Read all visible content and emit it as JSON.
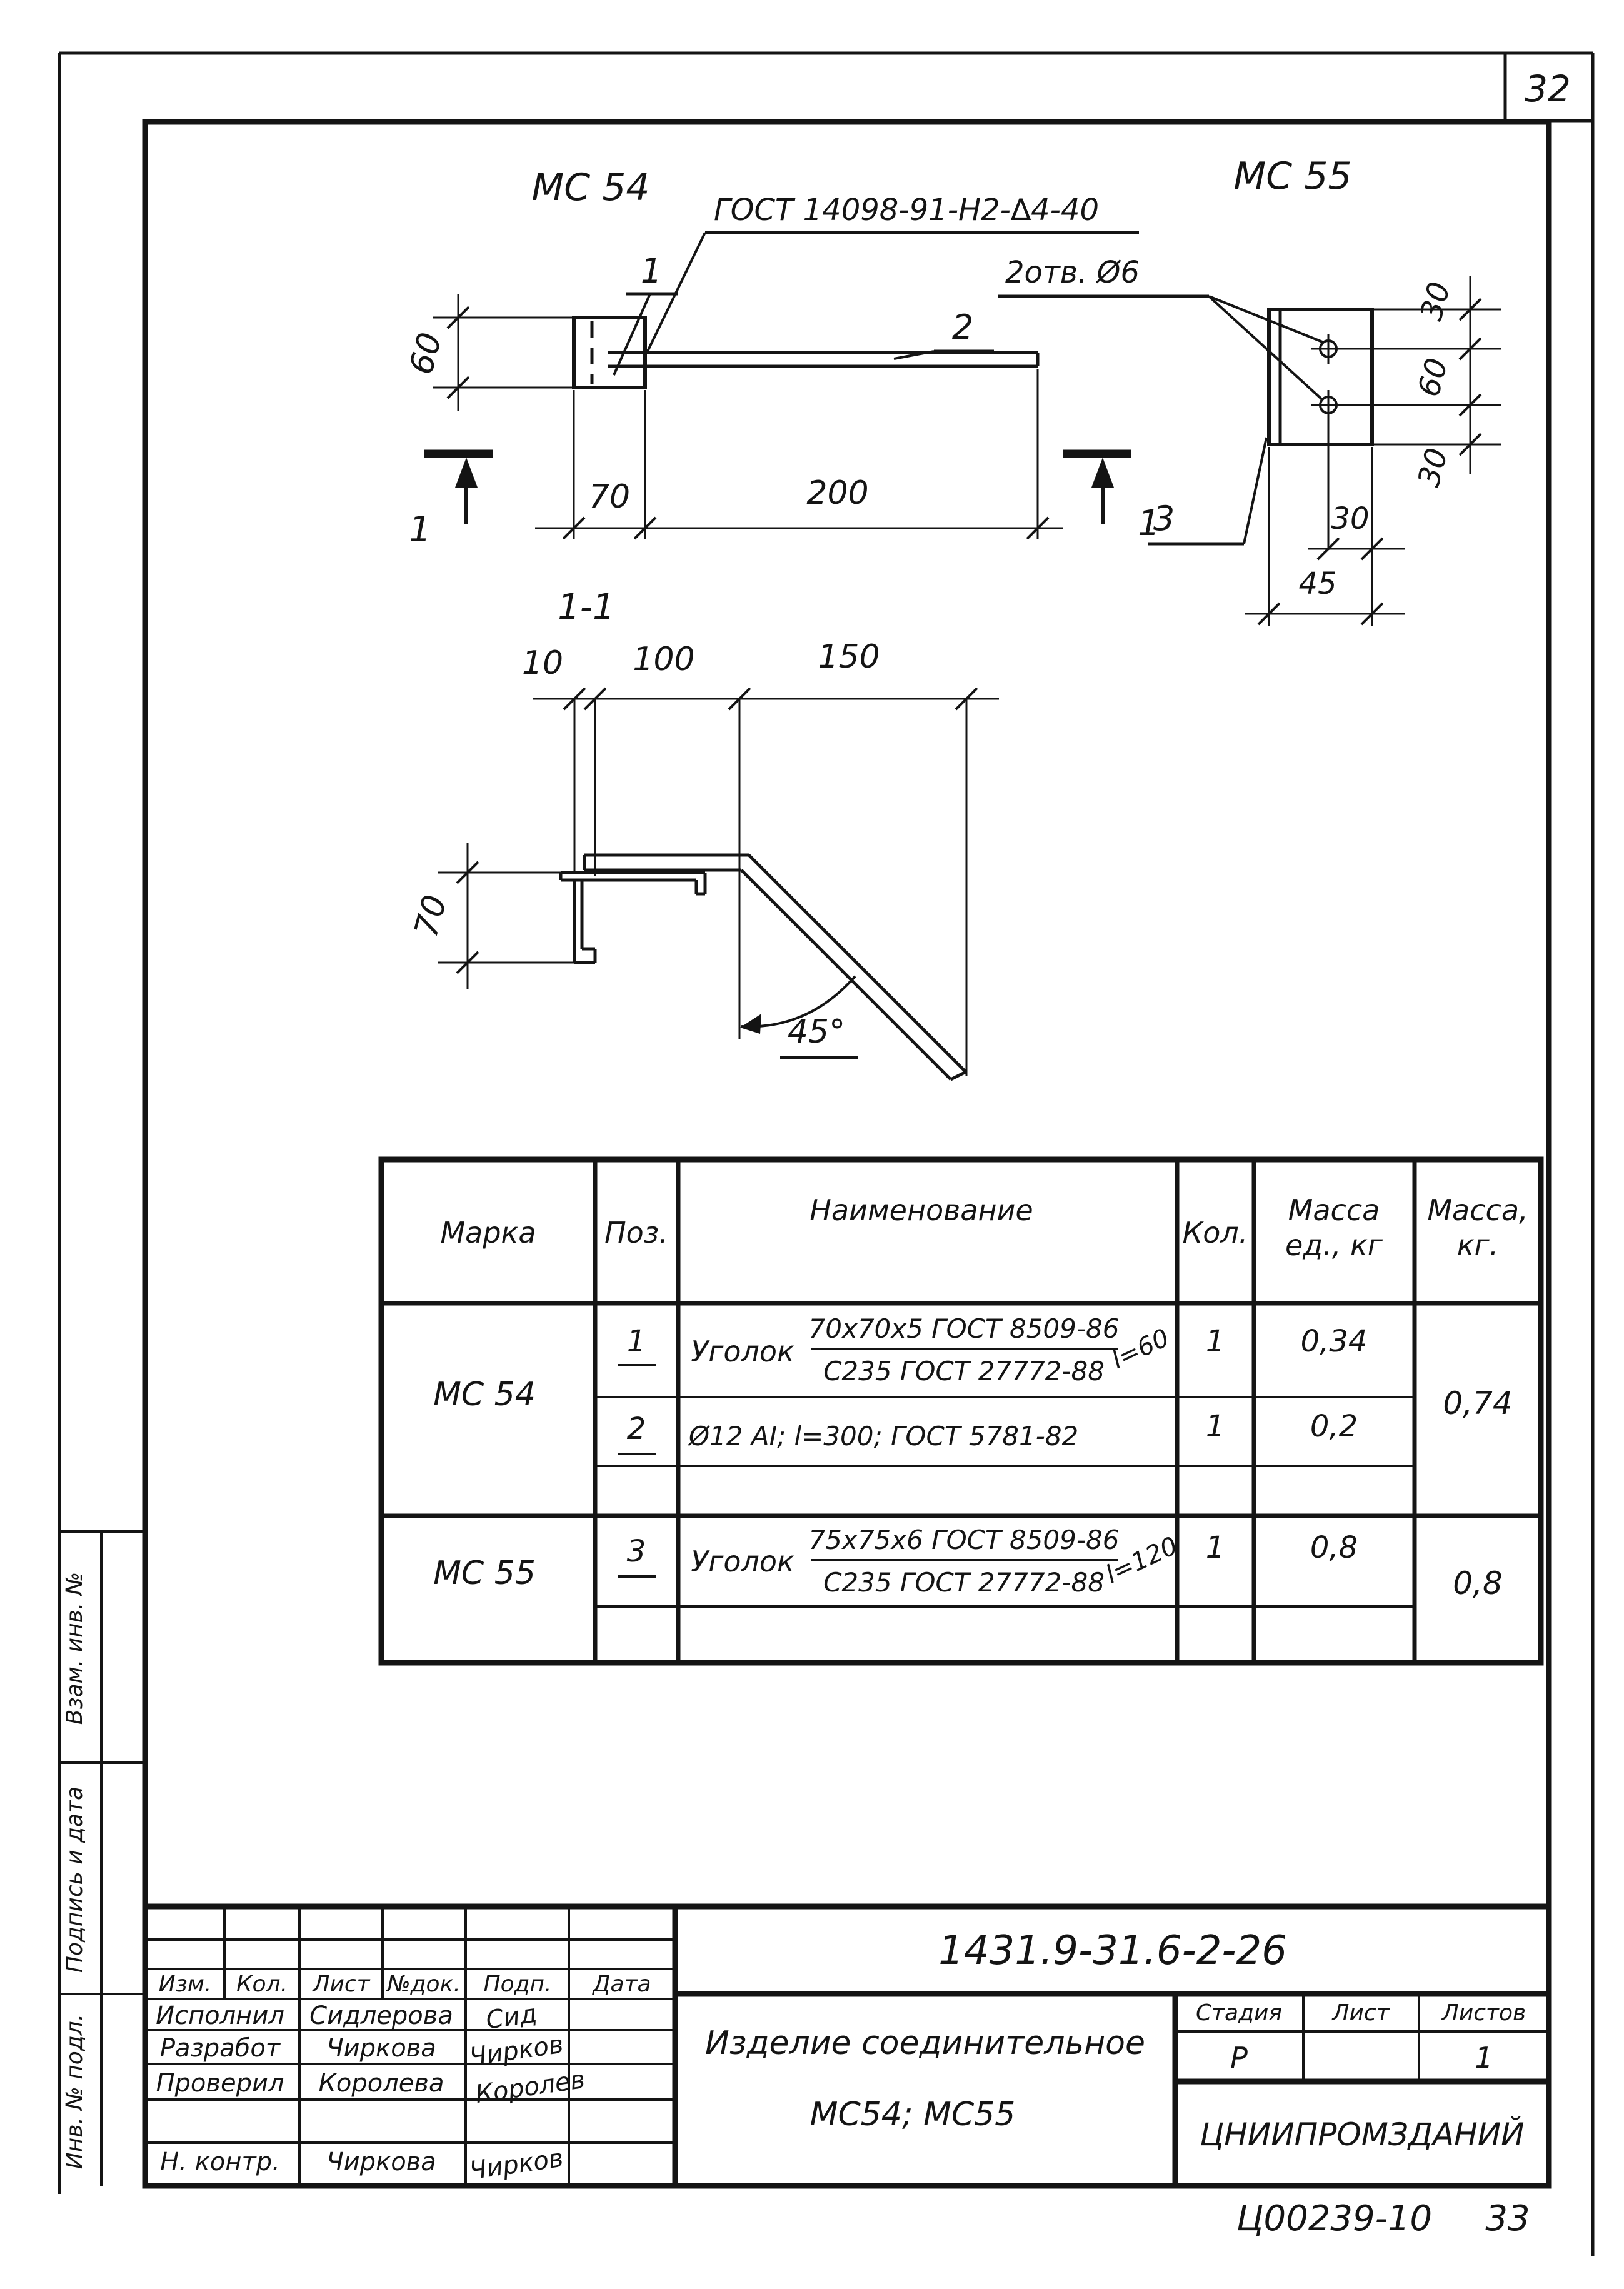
{
  "sheet": {
    "page_number": "32",
    "stamp_code": "Ц00239-10",
    "stamp_page": "33"
  },
  "mc54": {
    "title": "МС 54",
    "weld_label": "ГОСТ 14098-91-Н2-∆4-40",
    "pos1": "1",
    "pos2": "2",
    "dim60": "60",
    "dim70": "70",
    "dim200": "200",
    "cut1": "1",
    "cut2": "1"
  },
  "mc55": {
    "title": "МС 55",
    "holes_label": "2отв. Ø6",
    "pos3": "3",
    "dim30a": "30",
    "dim60": "60",
    "dim30b": "30",
    "dim30c": "30",
    "dim45": "45"
  },
  "section11": {
    "title": "1-1",
    "dim10": "10",
    "dim100": "100",
    "dim150": "150",
    "dim70": "70",
    "angle": "45°"
  },
  "spec": {
    "headers": {
      "marka": "Марка",
      "poz": "Поз.",
      "name": "Наименование",
      "qty": "Кол.",
      "mu1": "Масса",
      "mu2": "ед., кг",
      "mt1": "Масса,",
      "mt2": "кг."
    },
    "r1": {
      "marka": "МС 54",
      "poz": "1",
      "prefix": "Уголок",
      "num": "70х70х5 ГОСТ 8509-86",
      "den": "С235 ГОСТ 27772-88",
      "len": "l=60",
      "qty": "1",
      "mass": "0,34",
      "total": "0,74"
    },
    "r2": {
      "poz": "2",
      "name": "Ø12 АI; l=300; ГОСТ 5781-82",
      "qty": "1",
      "mass": "0,2"
    },
    "r3": {
      "marka": "МС 55",
      "poz": "3",
      "prefix": "Уголок",
      "num": "75х75х6 ГОСТ 8509-86",
      "den": "С235 ГОСТ 27772-88",
      "len": "l=120",
      "qty": "1",
      "mass": "0,8",
      "total": "0,8"
    }
  },
  "tb": {
    "doc": "1431.9-31.6-2-26",
    "prod1": "Изделие соединительное",
    "prod2": "МС54; МС55",
    "org": "ЦНИИПРОМЗДАНИЙ",
    "stage_h": "Стадия",
    "sheet_h": "Лист",
    "sheets_h": "Листов",
    "stage_v": "Р",
    "sheets_v": "1",
    "rev": {
      "izm": "Изм.",
      "kol": "Кол.",
      "list": "Лист",
      "ndok": "№док.",
      "podp": "Подп.",
      "data": "Дата"
    },
    "role1": "Исполнил",
    "role2": "Разработ",
    "role3": "Проверил",
    "role4": "Н. контр.",
    "name1": "Сидлерова",
    "name2": "Чиркова",
    "name3": "Королева",
    "name4": "Чиркова",
    "sig1": "Сид",
    "sig2": "Чирков",
    "sig3": "Королев",
    "sig4": "Чирков"
  },
  "strip": {
    "c1": "Взам. инв. №",
    "c2": "Подпись и дата",
    "c3": "Инв. № подл."
  }
}
